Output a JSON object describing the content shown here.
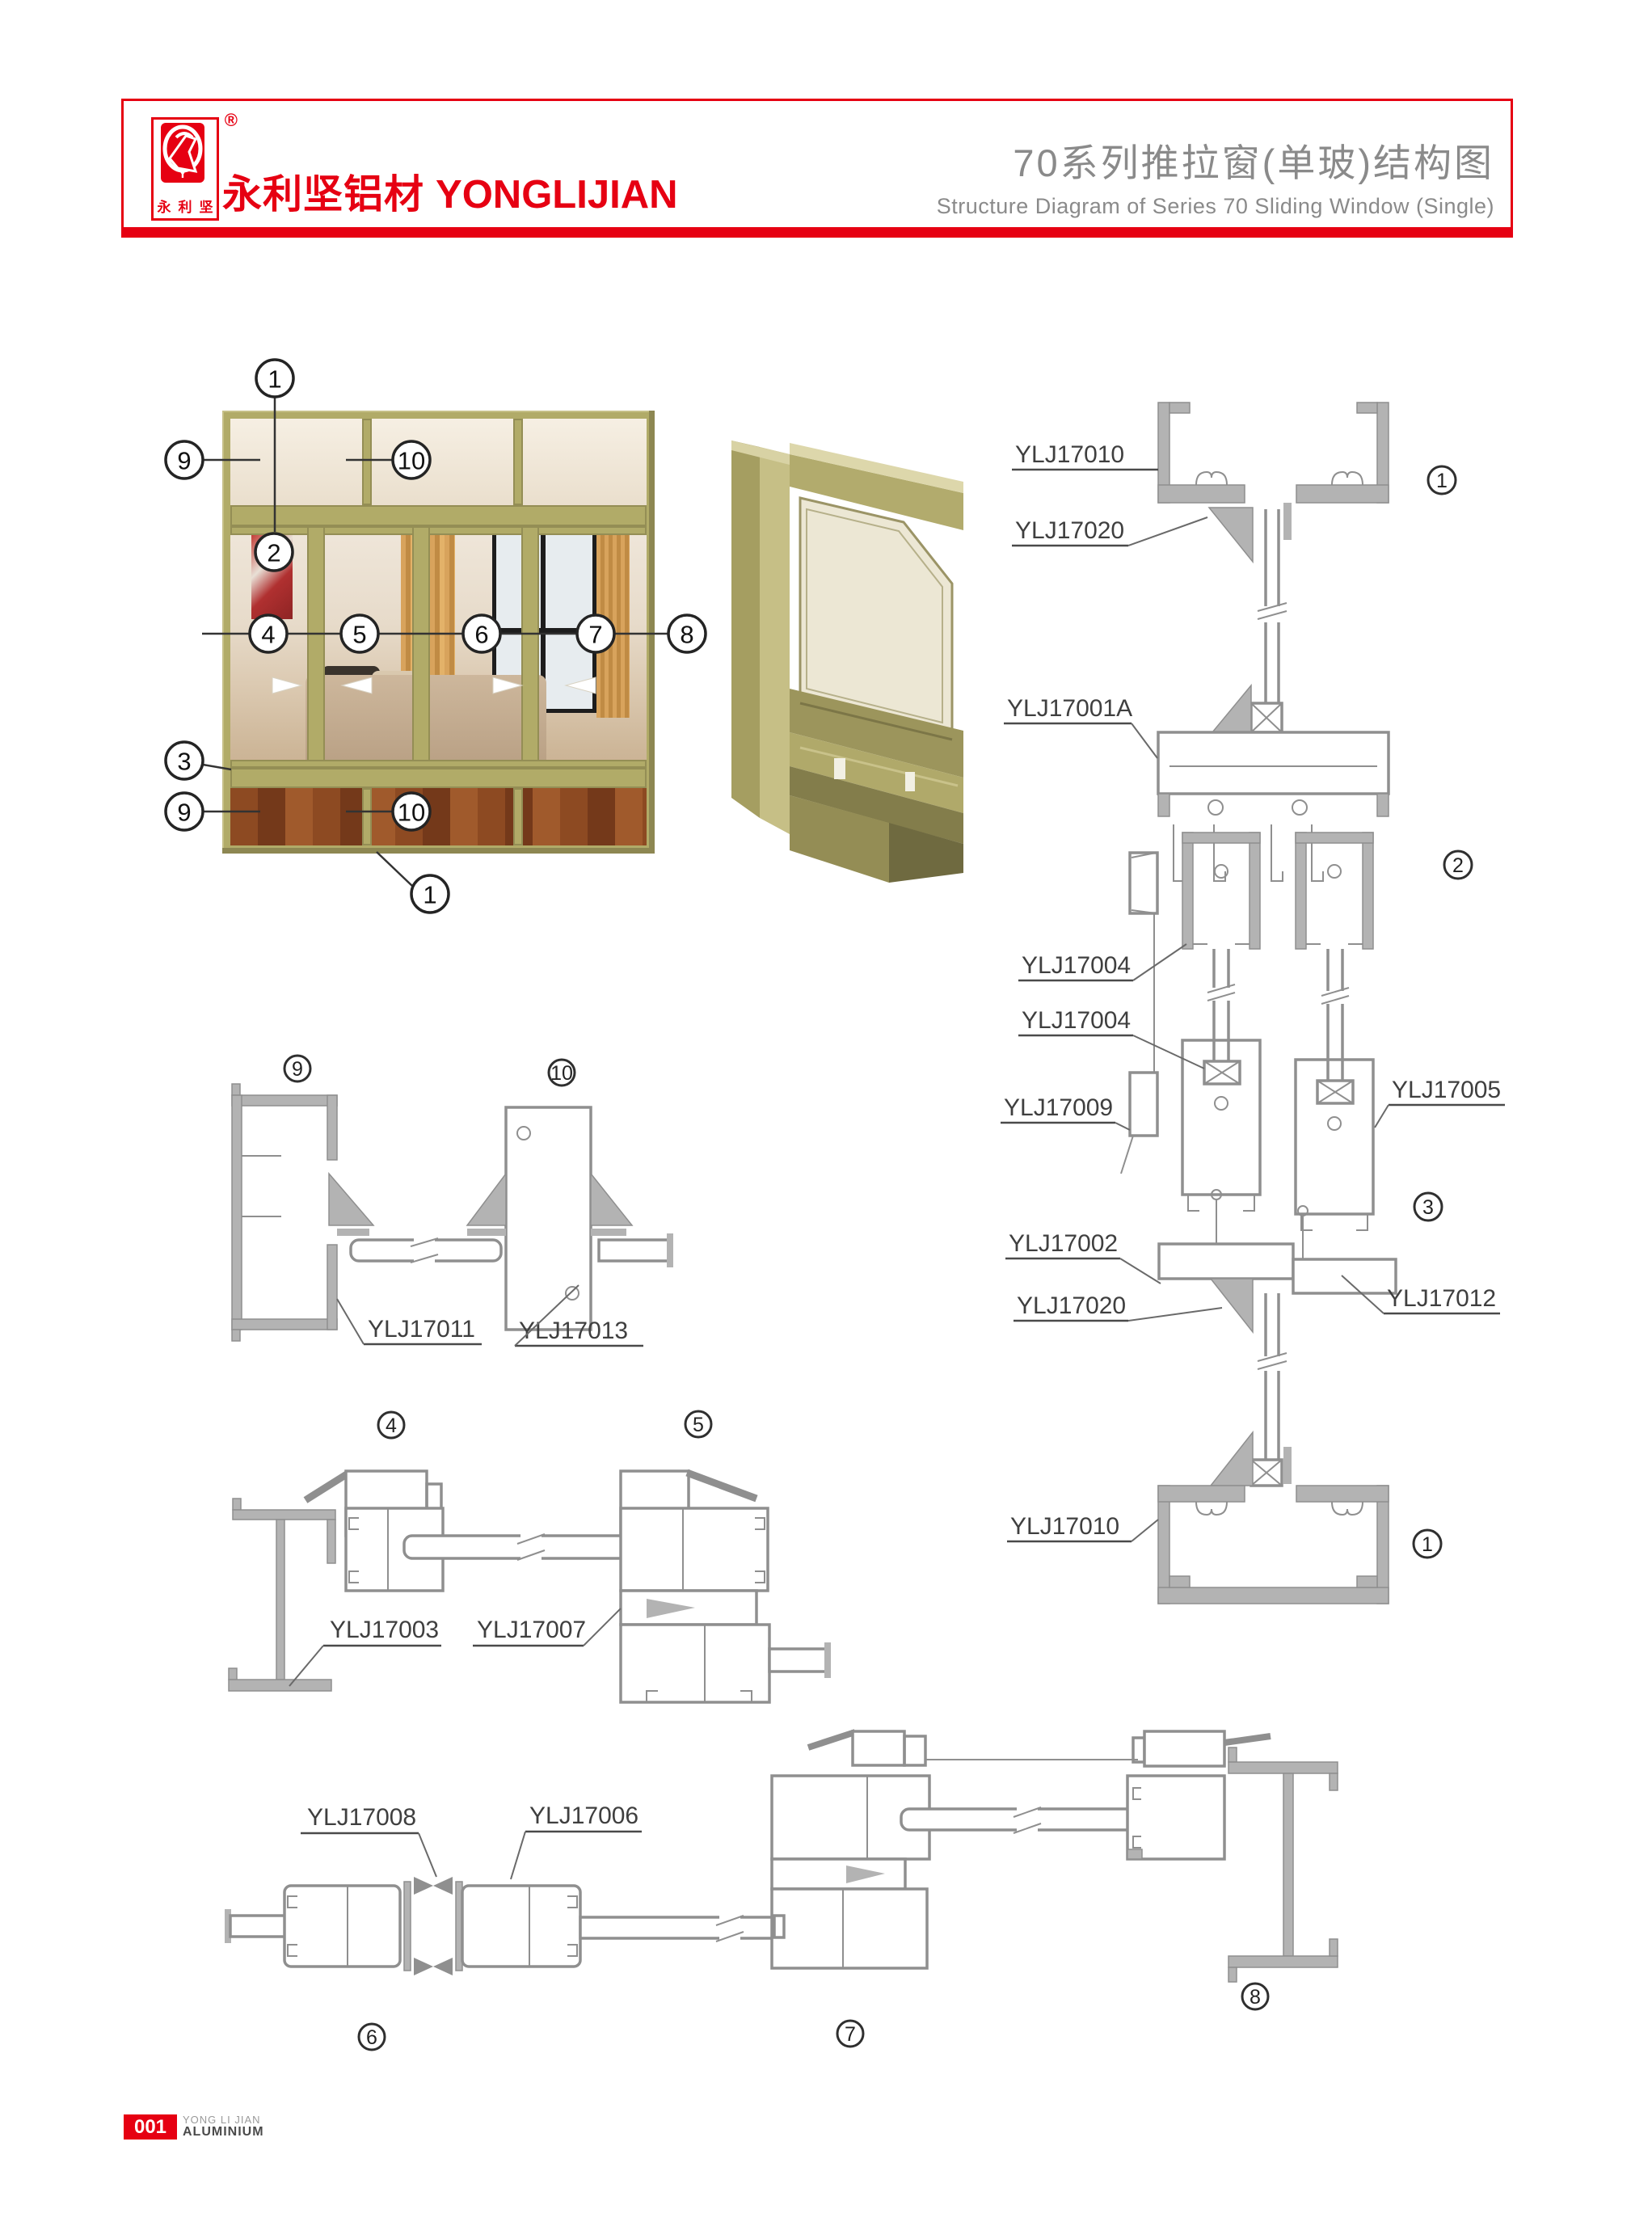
{
  "header": {
    "registered": "®",
    "logo_chars": [
      "永",
      "利",
      "坚"
    ],
    "brand_cn": "永利坚铝材",
    "brand_en": "YONGLIJIAN",
    "title_cn": "70系列推拉窗(单玻)结构图",
    "title_en": "Structure Diagram of Series 70 Sliding Window (Single)"
  },
  "colors": {
    "accent_red": "#e60012",
    "title_gray": "#8a8a8a",
    "frame_olive": "#b1ab68",
    "drawing_gray": "#8f8f8f"
  },
  "photo": {
    "callouts": [
      "1",
      "9",
      "10",
      "2",
      "4",
      "5",
      "6",
      "7",
      "8",
      "3",
      "9",
      "10",
      "1"
    ]
  },
  "right_section": {
    "labels": [
      {
        "text": "YLJ17010"
      },
      {
        "text": "YLJ17020"
      },
      {
        "text": "YLJ17001A"
      },
      {
        "text": "YLJ17004"
      },
      {
        "text": "YLJ17004"
      },
      {
        "text": "YLJ17009"
      },
      {
        "text": "YLJ17002"
      },
      {
        "text": "YLJ17020"
      },
      {
        "text": "YLJ17010"
      },
      {
        "text": "YLJ17005"
      },
      {
        "text": "YLJ17012"
      }
    ],
    "circles": [
      "1",
      "2",
      "3",
      "1"
    ]
  },
  "detail_910": {
    "circles": [
      "9",
      "10"
    ],
    "label_left": "YLJ17011",
    "label_right": "YLJ17013"
  },
  "detail_45": {
    "circles": [
      "4",
      "5"
    ],
    "label_left": "YLJ17003",
    "label_right": "YLJ17007"
  },
  "detail_678": {
    "circles": [
      "6",
      "7",
      "8"
    ],
    "label_left": "YLJ17008",
    "label_right": "YLJ17006"
  },
  "footer": {
    "page": "001",
    "company_line1": "YONG LI JIAN",
    "company_line2": "ALUMINIUM"
  }
}
